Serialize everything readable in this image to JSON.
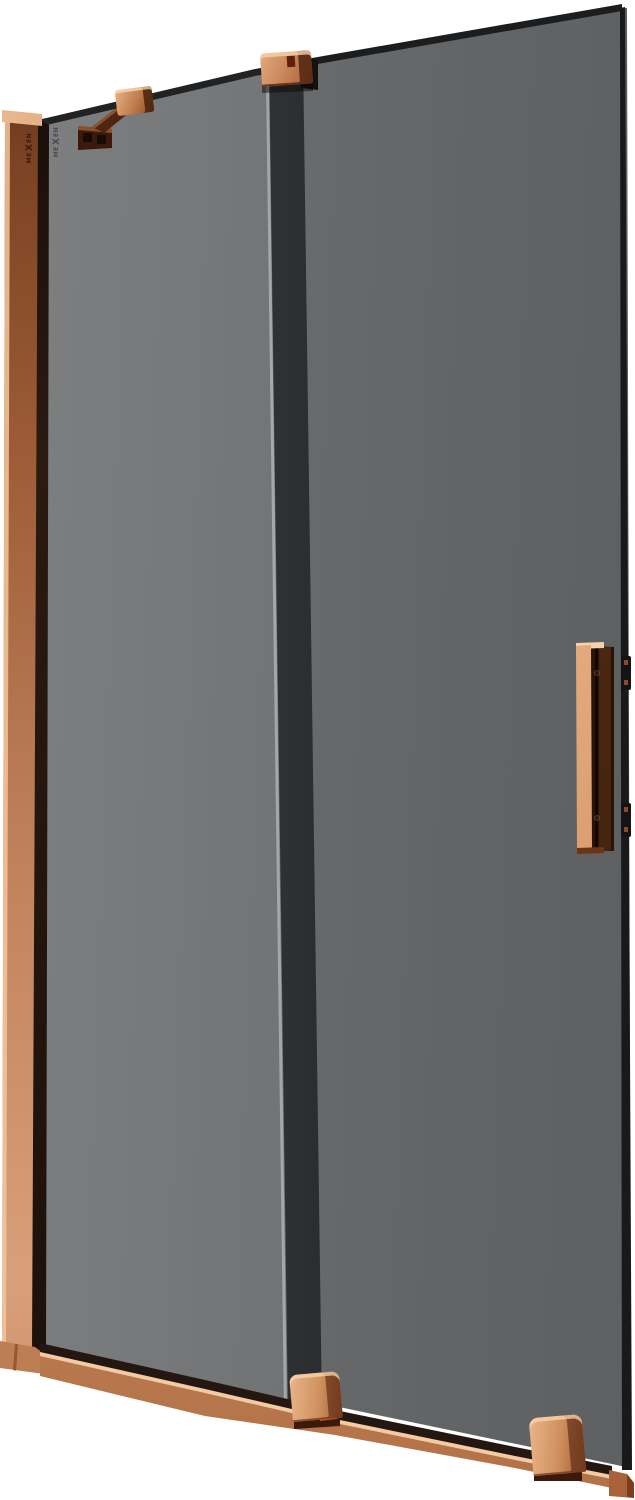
{
  "brand": {
    "pre": "ME",
    "x": "X",
    "post": "EN"
  },
  "colors": {
    "background": "#ffffff",
    "copper_highlight": "#f3cba3",
    "copper_light": "#e0a678",
    "copper_mid": "#c08254",
    "copper_dark": "#8a4a26",
    "copper_deep": "#542710",
    "bronze_shadow": "#3b1a0c",
    "accent_orange": "#c5502a",
    "glass_light": "#7d7f81",
    "glass_mid": "#6e7072",
    "glass_dark": "#5e6062",
    "glass_edge_dark": "#202223",
    "frame_black": "#17191b",
    "logo_on_copper": "#3b1c0c",
    "logo_on_glass": "#43464a"
  }
}
